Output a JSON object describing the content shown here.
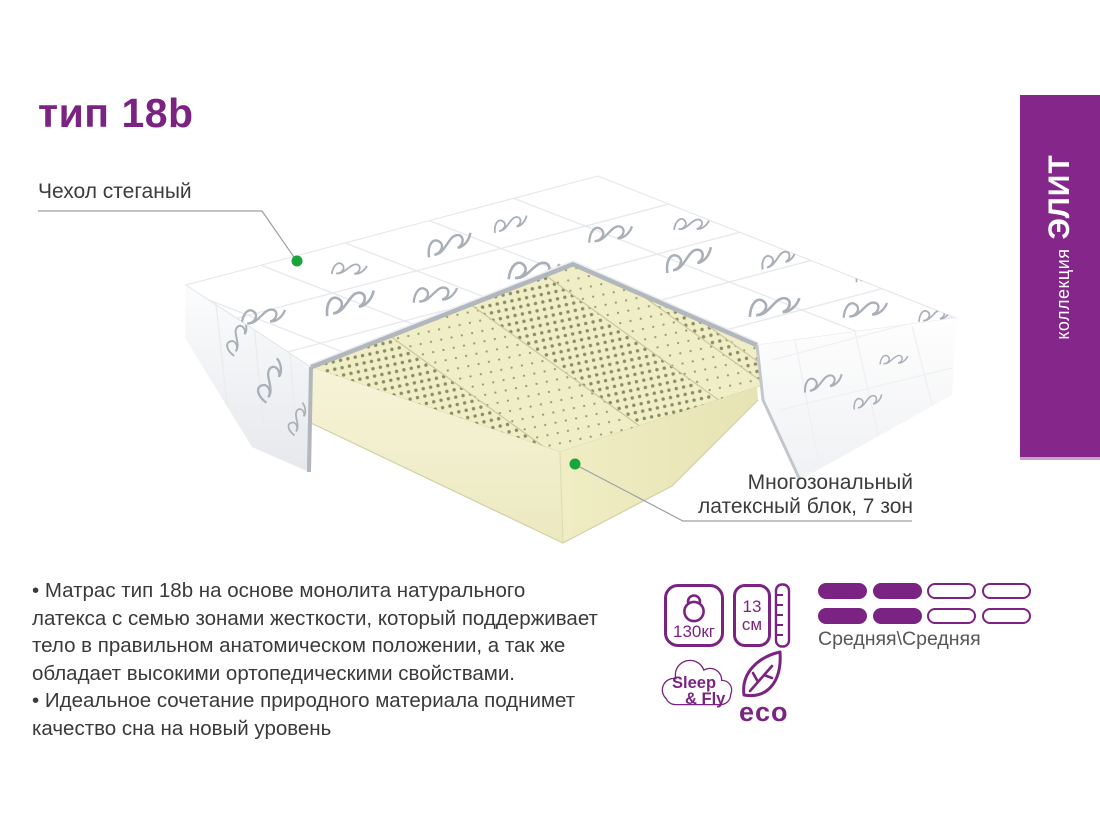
{
  "title": "тип 18b",
  "banner": {
    "collection_label": "коллекция",
    "collection_name": "ЭЛИТ"
  },
  "callouts": {
    "cover_label": "Чехол стеганый",
    "latex_line1": "Многозональный",
    "latex_line2": "латексный блок, 7 зон"
  },
  "description": {
    "lines": [
      "• Матрас тип 18b на основе монолита натурального",
      "латекса с семью зонами жесткости, который поддерживает",
      "тело в правильном анатомическом положении, а так же",
      "обладает высокими ортопедическими свойствами.",
      "• Идеальное сочетание природного материала поднимет",
      "качество сна на новый уровень"
    ]
  },
  "specs": {
    "max_weight": "130кг",
    "height_value": "13",
    "height_unit": "см",
    "firmness_label": "Средняя\\Средняя",
    "firmness_cells": [
      1,
      1,
      0,
      0,
      1,
      1,
      0,
      0
    ]
  },
  "brand": {
    "name_line1": "Sleep",
    "name_line2": "& Fly",
    "eco_label": "eco"
  },
  "colors": {
    "accent_purple": "#7b2382",
    "banner_purple": "#85268b",
    "marker_green": "#17a53c",
    "latex_cream": "#f0eec6"
  }
}
